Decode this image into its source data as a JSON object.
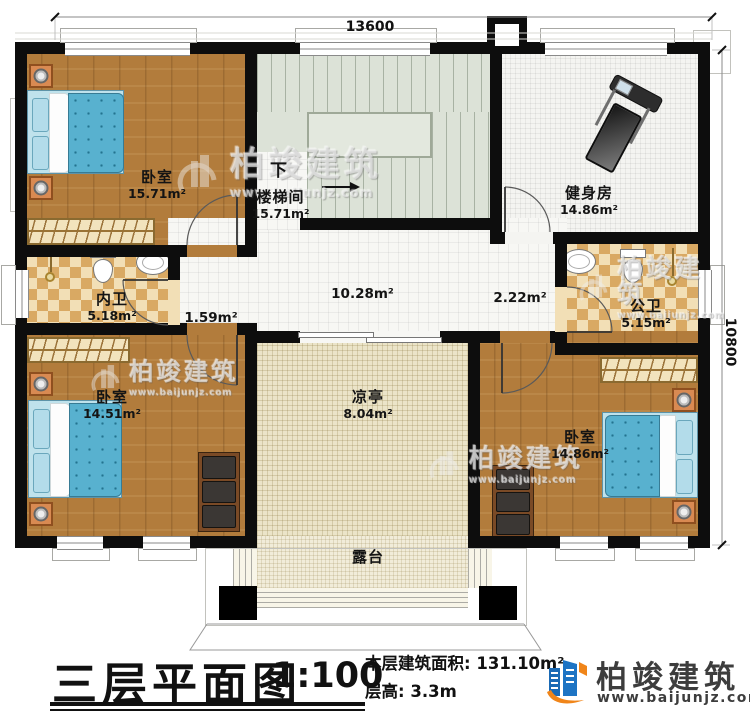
{
  "dimensions": {
    "width_label": "13600",
    "height_label": "10800"
  },
  "rooms": {
    "bedroom_tl": {
      "name": "卧室",
      "area": "15.71m²"
    },
    "stairwell": {
      "name": "楼梯间",
      "area": "15.71m²",
      "direction_label": "下"
    },
    "gym": {
      "name": "健身房",
      "area": "14.86m²"
    },
    "inner_bathroom": {
      "name": "内卫",
      "area": "5.18m²"
    },
    "public_bathroom": {
      "name": "公卫",
      "area": "5.15m²"
    },
    "hall": {
      "area": "10.28m²"
    },
    "hall_west": {
      "area": "1.59m²"
    },
    "hall_east": {
      "area": "2.22m²"
    },
    "bedroom_bl": {
      "name": "卧室",
      "area": "14.51m²"
    },
    "bedroom_br": {
      "name": "卧室",
      "area": "14.86m²"
    },
    "pavilion": {
      "name": "凉亭",
      "area": "8.04m²"
    },
    "terrace": {
      "name": "露台"
    }
  },
  "title_block": {
    "plan_title": "三层平面图",
    "scale": "1:100",
    "floor_area_label": "本层建筑面积:",
    "floor_area_value": "131.10m²",
    "floor_height_label": "层高:",
    "floor_height_value": "3.3m"
  },
  "brand": {
    "company_name": "柏竣建筑",
    "website": "www.baijunjz.com"
  },
  "watermark": {
    "text": "柏竣建筑",
    "website": "www.baijunjz.com"
  },
  "colors": {
    "wall": "#0d0d0d",
    "wood_floor": "#b27c3c",
    "tile_checker": "#d9a963",
    "stair_floor": "#dce2d7",
    "pavilion_floor": "#ebe4c8",
    "brand_blue": "#1d74c4",
    "brand_orange": "#f08519"
  }
}
